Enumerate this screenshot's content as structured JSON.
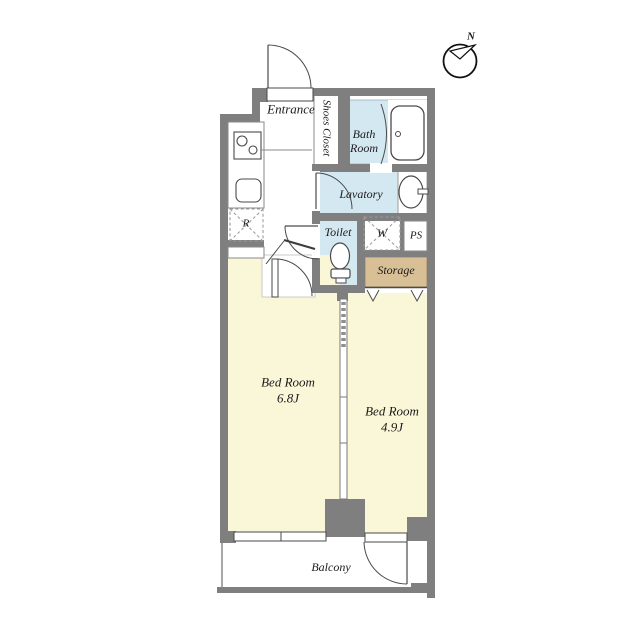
{
  "colors": {
    "wall": "#7f7f7f",
    "wet_room_fill": "#d4e8f1",
    "bedroom_fill": "#faf7d8",
    "storage_fill": "#d8bf95",
    "interior_fill": "#ffffff",
    "line": "#4a4a4a",
    "background": "#ffffff"
  },
  "compass": {
    "north_label": "N"
  },
  "rooms": {
    "entrance": {
      "label": "Entrance"
    },
    "shoes_closet": {
      "label": "Shoes Closet"
    },
    "bath_room": {
      "label": "Bath Room"
    },
    "lavatory": {
      "label": "Lavatory"
    },
    "toilet": {
      "label": "Toilet"
    },
    "washing_machine": {
      "label": "W"
    },
    "pipe_space": {
      "label": "PS"
    },
    "storage": {
      "label": "Storage"
    },
    "refrigerator": {
      "label": "R"
    },
    "bedroom_1": {
      "label": "Bed Room",
      "size": "6.8J"
    },
    "bedroom_2": {
      "label": "Bed Room",
      "size": "4.9J"
    },
    "balcony": {
      "label": "Balcony"
    }
  }
}
